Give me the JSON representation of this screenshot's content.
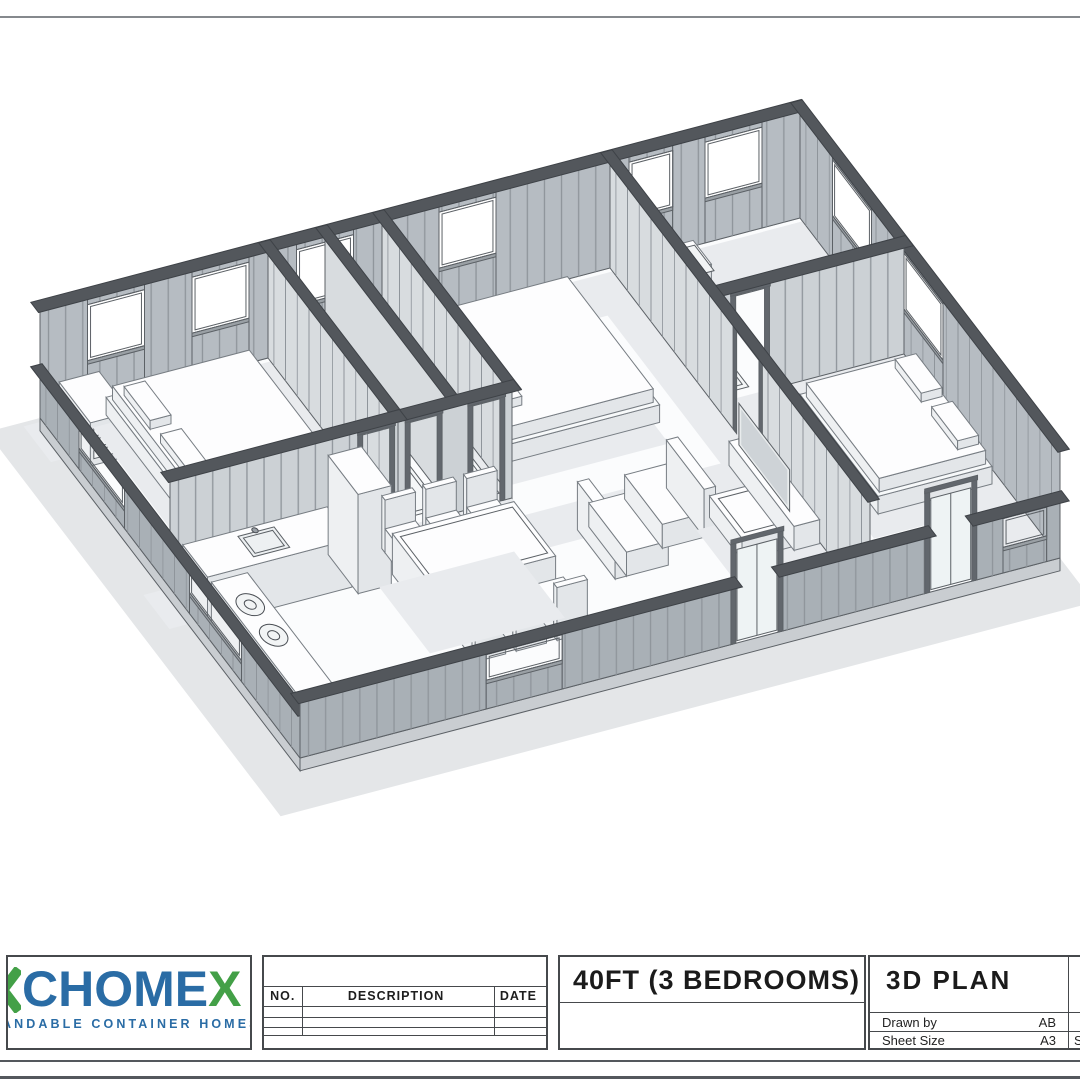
{
  "sheet": {
    "background": "#ffffff",
    "border_color": "#85898d"
  },
  "plan": {
    "description": "isometric 3D cutaway floor plan of a 40ft three-bedroom expandable container home",
    "exterior_wall_fill": "#b6bcc2",
    "partition_fill": "#ccd1d5",
    "near_wall_fill": "#a9b0b6",
    "line_color": "#5c6166",
    "floor_fill": "#fbfcfd",
    "shadow_fill": "#e9ebee"
  },
  "logo": {
    "fragment_icon": "partial-green-letter",
    "brand_main": "CHOME",
    "brand_accent": "X",
    "brand_main_color": "#2a6ca5",
    "brand_accent_color": "#43a047",
    "tagline_visible": "ANDABLE CONTAINER HOMES",
    "tagline_color": "#2a6ca5"
  },
  "revision_table": {
    "headers": [
      "NO.",
      "DESCRIPTION",
      "DATE"
    ],
    "rows": [
      [
        "",
        "",
        ""
      ],
      [
        "",
        "",
        ""
      ],
      [
        "",
        "",
        ""
      ]
    ]
  },
  "title_block": {
    "drawing_title": "40FT (3 BEDROOMS)",
    "view_label": "3D PLAN",
    "fields": [
      {
        "label": "Drawn by",
        "value": "AB"
      },
      {
        "label": "Sheet Size",
        "value": "A3"
      }
    ],
    "clipped_column_label": "S"
  }
}
